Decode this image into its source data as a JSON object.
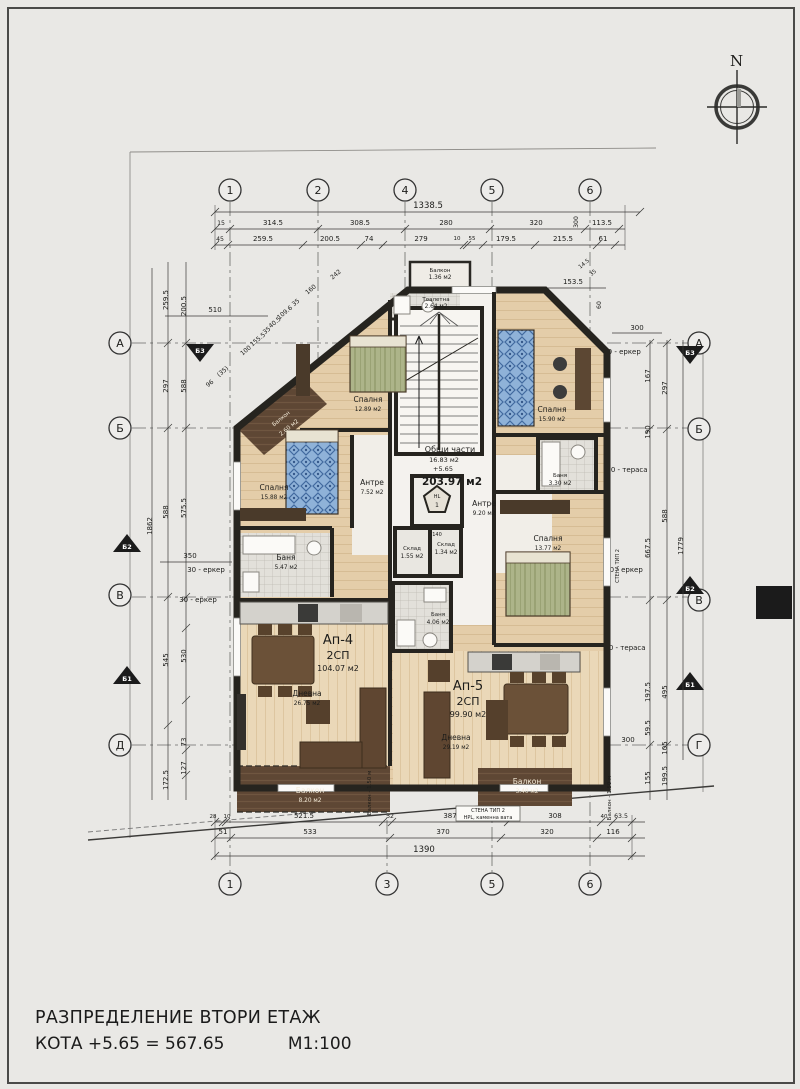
{
  "title": {
    "line1": "РАЗПРЕДЕЛЕНИЕ ВТОРИ ЕТАЖ",
    "kota": "КОТА +5.65 = 567.65",
    "scale": "М1:100"
  },
  "north_label": "N",
  "axes": {
    "top": [
      "1",
      "2",
      "4",
      "5",
      "6"
    ],
    "bottom": [
      "1",
      "3",
      "5",
      "6"
    ],
    "left": [
      "А",
      "Б",
      "В",
      "Д"
    ],
    "right": [
      "А",
      "Б",
      "В",
      "Г"
    ],
    "sections": {
      "b1": "Б1",
      "b2": "Б2",
      "b3": "Б3"
    }
  },
  "dims": {
    "top_total": "1338.5",
    "top_row1": [
      "15",
      "314.5",
      "308.5",
      "280",
      "320",
      "113.5"
    ],
    "top_row1_vert": "300",
    "top_row2": [
      "45",
      "259.5",
      "200.5",
      "74",
      "279",
      "10",
      "55",
      "179.5",
      "215.5",
      "61"
    ],
    "bottom_row1": [
      "28",
      "10",
      "521.5",
      "32",
      "387",
      "308",
      "40",
      "63.5"
    ],
    "bottom_row2": [
      "51",
      "533",
      "370",
      "320",
      "116"
    ],
    "bottom_total": "1390",
    "left_col": [
      "259.5",
      "200.5",
      "297",
      "273.5",
      "588",
      "575.5",
      "1862",
      "350",
      "530",
      "545",
      "73",
      "127",
      "172.5",
      "510"
    ],
    "left_erker1": "30 - еркер",
    "left_erker2": "30 - еркер",
    "right_col": [
      "167",
      "297",
      "190",
      "588",
      "667.5",
      "1779",
      "197.5",
      "495",
      "59.5",
      "105",
      "155",
      "199.5"
    ],
    "right_misc": {
      "d300_top": "300",
      "d300_bot": "300",
      "d153": "153.5",
      "d60": "60",
      "d145": "14.5",
      "d35": "35"
    },
    "right_erker90": "90 - еркер",
    "right_terasa1": "90 - тераса",
    "right_erker30": "30 - еркер",
    "right_terasa2": "90 - тераса",
    "diag": [
      "242",
      "160",
      "35",
      "109.6",
      "40.5",
      "35",
      "155.5",
      "100",
      "(35)",
      "96"
    ]
  },
  "rooms": {
    "balkon_top": {
      "name": "Балкон",
      "area": "1.36 м2"
    },
    "toaletna": {
      "name": "Тоалетна",
      "area": "2.64 м2"
    },
    "sp_nw": {
      "name": "Спалня",
      "area": "12.89 м2"
    },
    "sp_w": {
      "name": "Спалня",
      "area": "15.88 м2"
    },
    "sp_ne": {
      "name": "Спалня",
      "area": "15.90 м2"
    },
    "sp_e": {
      "name": "Спалня",
      "area": "13.77 м2"
    },
    "bania_w": {
      "name": "Баня",
      "area": "5.47 м2"
    },
    "bania_e": {
      "name": "Баня",
      "area": "3.30 м2"
    },
    "bania_s": {
      "name": "Баня",
      "area": "4.06 м2"
    },
    "sklad1": {
      "name": "Склад",
      "area": "1.55 м2"
    },
    "sklad2": {
      "name": "Склад",
      "area": "1.34 м2"
    },
    "antre_w": {
      "name": "Антре",
      "area": "7.52 м2"
    },
    "antre_e": {
      "name": "Антре",
      "area": "9.20 м2"
    },
    "balkon_nw": {
      "name": "Балкон",
      "area": "2.60 м2"
    },
    "balkon_sw": {
      "name": "Балкон",
      "area": "8.20 м2"
    },
    "balkon_se": {
      "name": "Балкон",
      "area": "3.40 м2"
    }
  },
  "common": {
    "name": "Общи части",
    "area": "16.83 м2",
    "level": "+5.65",
    "total_area": "203.97 м2"
  },
  "apartments": {
    "ap4": {
      "id": "Ап-4",
      "type": "2СП",
      "area": "104.07 м2",
      "living": {
        "name": "Дневна",
        "area": "26.75 м2"
      }
    },
    "ap5": {
      "id": "Ап-5",
      "type": "2СП",
      "area": "99.90 м2",
      "living": {
        "name": "Дневна",
        "area": "29.19 м2"
      }
    }
  },
  "elevator": {
    "label": "HL",
    "number": "1",
    "width": "140"
  },
  "notes": {
    "balkon_150_a": "Балкон - 1.50 м",
    "balkon_150_b": "Балкон - 1.50 м",
    "wall_type_title": "СТЕНА ТИП 2",
    "wall_type_sub": "HPL, каменна вата",
    "wall_type_side": "СТЕНА ТИП 2"
  }
}
